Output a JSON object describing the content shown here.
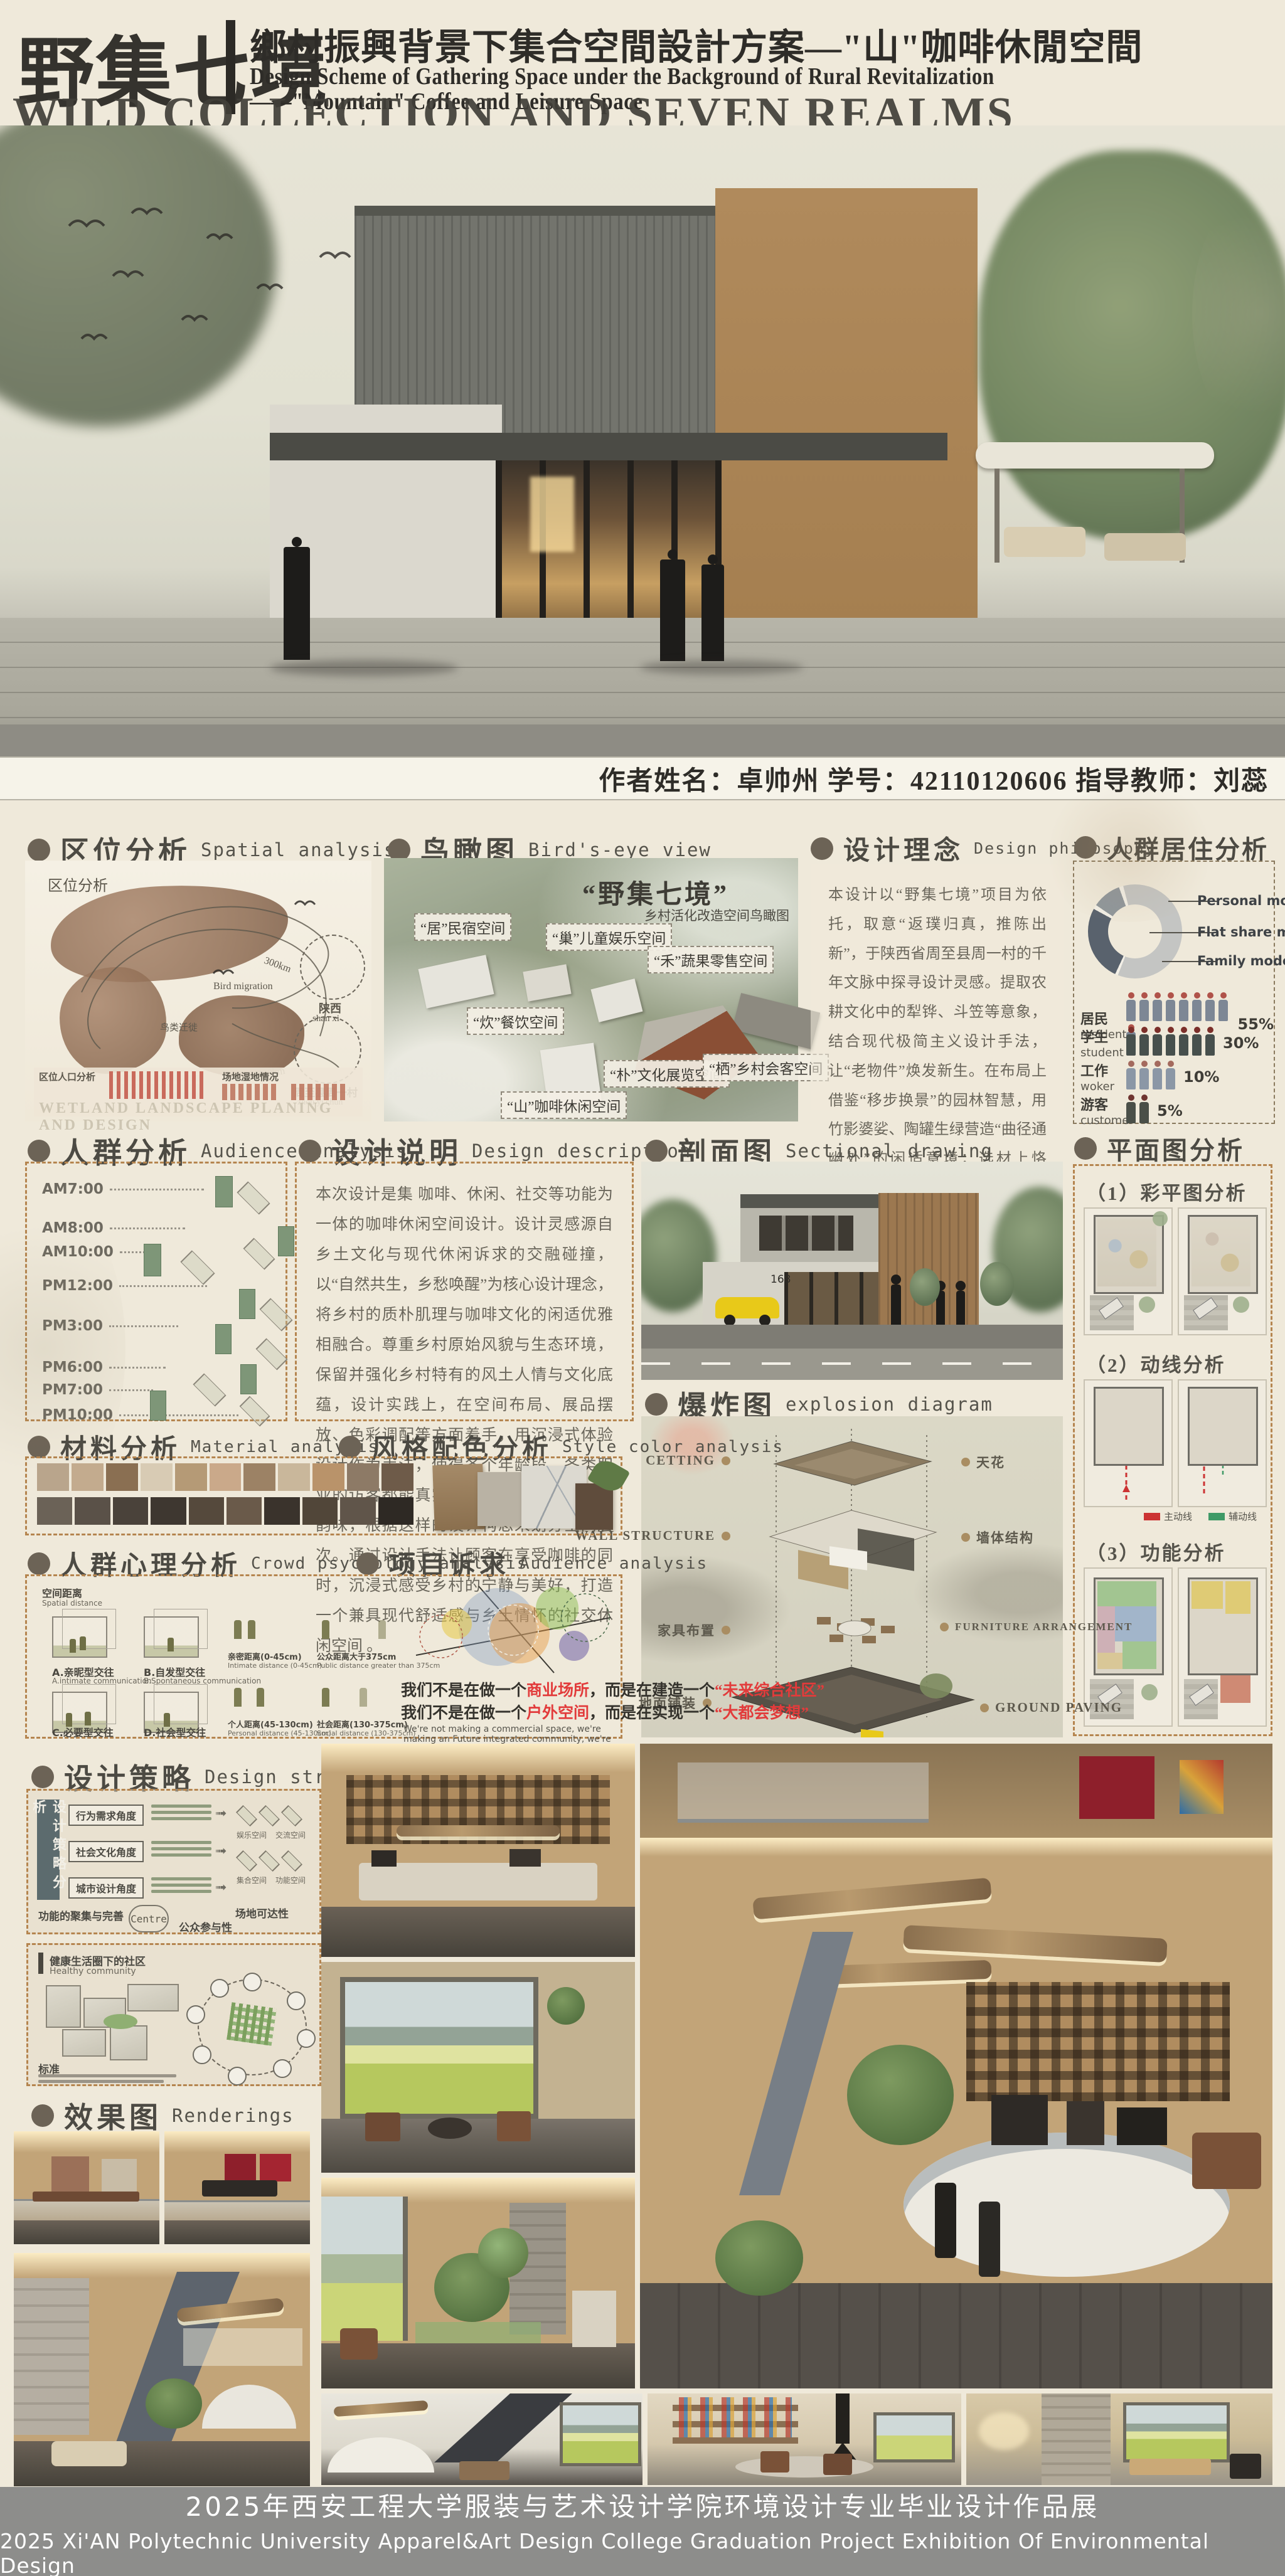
{
  "header": {
    "title_cn": "野集七境",
    "subtitle_cn": "鄉村振興背景下集合空間設計方案—\"山\"咖啡休閒空間",
    "subtitle_en_line1": "Design Scheme of Gathering Space under the Background of Rural Revitalization",
    "subtitle_en_line2": "——\"Mountain\" Coffee and Leisure Space",
    "title_en": "WILD COLLECTION AND SEVEN REALMS"
  },
  "author_bar": {
    "text": "作者姓名：卓帅州  学号：42110120606  指导教师：刘蕊"
  },
  "spatial": {
    "cn": "区位分析",
    "en": "Spatial analysis",
    "corner": "区位分析",
    "bird_migration_en": "Bird migration",
    "bird_migration_cn": "鸟类迁徙",
    "shanxi_cn": "陕西",
    "shanxi_en": "shan xi",
    "dist": "300km",
    "village_cn": "周至县周一村",
    "village_en": "zhou yi chun",
    "pop_label": "区位人口分析",
    "wetland_label": "场地湿地情况",
    "watermark": "WETLAND LANDSCAPE PLANING AND DESIGN"
  },
  "birdseye": {
    "cn": "鸟瞰图",
    "en": "Bird's-eye view",
    "caption_big": "“野集七境”",
    "caption_small": "乡村活化改造空间鸟瞰图",
    "labels": [
      "“居”民宿空间",
      "“巢”儿童娱乐空间",
      "“禾”蔬果零售空间",
      "“炊”餐饮空间",
      "“朴”文化展览空间",
      "“栖”乡村会客空间",
      "“山”咖啡休闲空间"
    ]
  },
  "philosophy": {
    "cn": "设计理念",
    "en": "Design philosophy",
    "body": "本设计以“野集七境”项目为依托，取意“返璞归真，推陈出新”，于陕西省周至县周一村的千年文脉中探寻设计灵感。提取农耕文化中的犁铧、斗笠等意象，结合现代极简主义设计手法，让“老物件”焕发新生。在布局上借鉴“移步换景”的园林智慧，用竹影婆娑、陶罐生绿营造“曲径通幽处”的闲适意境；选材上恪守“因地制宜”，以夯土、原木、藤编传递“道法自然”的生态理念。力求在“古意今承”间，打造一处既能品味咖啡醇香，又可触摸乡土温度的诗意空间，探索乡村公共空间活化的“破界新生”之道。"
  },
  "residence": {
    "cn": "人群居住分析",
    "donut_labels": [
      "Personal mode",
      "Flat share mode",
      "Family mode"
    ],
    "rows": [
      {
        "cn": "居民",
        "en": "resident",
        "pct": "55%",
        "count": 9
      },
      {
        "cn": "学生",
        "en": "student",
        "pct": "30%",
        "count": 7
      },
      {
        "cn": "工作",
        "en": "woker",
        "pct": "10%",
        "count": 4
      },
      {
        "cn": "游客",
        "en": "customer",
        "pct": "5%",
        "count": 2
      }
    ]
  },
  "audience": {
    "cn": "人群分析",
    "en": "Audience analysis",
    "times": [
      "AM7:00",
      "AM8:00",
      "AM10:00",
      "PM12:00",
      "PM3:00",
      "PM6:00",
      "PM7:00",
      "PM10:00"
    ]
  },
  "description": {
    "cn": "设计说明",
    "en": "Design description",
    "body": "本次设计是集 咖啡、休闲、社交等功能为一体的咖啡休闲空间设计。设计灵感源自乡土文化与现代休闲诉求的交融碰撞，以“自然共生，乡愁唤醒”为核心设计理念，将乡村的质朴肌理与咖啡文化的闲适优雅相融合。尊重乡村原始风貌与生态环境，保留并强化乡村特有的风土人情与文化底蕴，设计实践上，在空间布局、展品摆放、色彩调配等方面着手，用沉浸式体验设计作为手法，使得各个年龄段、各类职业的访客都能真实领略到乡土文化的特别韵味，根据这样的设计构思来划分空间层次。通过设计手法让顾客在享受咖啡的同时，沉浸式感受乡村的宁静与美好，打造一个兼具现代舒适感与乡土情怀的社交休闲空间 。"
  },
  "sectional": {
    "cn": "剖面图",
    "en": "Sectional drawing",
    "house_number": "168"
  },
  "plans": {
    "cn": "平面图分析",
    "sub1": "（1）彩平图分析",
    "sub2": "（2）动线分析",
    "sub3": "（3）功能分析",
    "legend_main": "主动线",
    "legend_aux": "辅动线"
  },
  "explosion": {
    "cn": "爆炸图",
    "en": "explosion diagram",
    "l1_left": "CETTING",
    "l1_right": "天花",
    "l2_left": "WALL STRUCTURE",
    "l2_right": "墙体结构",
    "l3_left": "家具布置",
    "l3_right": "FURNITURE ARRANGEMENT",
    "l4_left": "地面铺装",
    "l4_right": "GROUND PAVING"
  },
  "material": {
    "cn": "材料分析",
    "en": "Material analysis"
  },
  "style_color": {
    "cn": "风格配色分析",
    "en": "Style color analysis"
  },
  "psychology": {
    "cn": "人群心理分析",
    "en": "Crowd psychology analysis",
    "space_cn": "空间距离",
    "space_en": "Spatial distance",
    "types": [
      {
        "cn": "A.亲昵型交往",
        "en": "A.intimate communication"
      },
      {
        "cn": "B.自发型交往",
        "en": "B.Spontaneous communication"
      },
      {
        "cn": "C.必要型交往",
        "en": "C.Necessary communication"
      },
      {
        "cn": "D.社会型交往",
        "en": "D.Social communication"
      }
    ],
    "distances": [
      {
        "cn": "亲密距离(0-45cm)",
        "en": "Intimate distance (0-45cm)"
      },
      {
        "cn": "公众距离大于375cm",
        "en": "Public distance greater than 375cm"
      },
      {
        "cn": "个人距离(45-130cm)",
        "en": "Personal distance (45-130cm)"
      },
      {
        "cn": "社会距离(130-375cm)",
        "en": "Social distance (130-375cm)"
      }
    ]
  },
  "appeal": {
    "cn": "项目诉求",
    "en": "Audience analysis",
    "line1_pre": "我们不是在做一个",
    "line1_hl1": "商业场所",
    "line1_mid": "，而是在建造一个",
    "line1_hl2": "“未来综合社区”",
    "line2_pre": "我们不是在做一个",
    "line2_hl1": "户外空间",
    "line2_mid": "，而是在实现一个",
    "line2_hl2": "“大都会梦想”",
    "en_line": "We're not making a commercial space, we're making an Future integrated community, we're not making an outdoor space, we're making The metropolis dream"
  },
  "strategy": {
    "cn": "设计策略",
    "en": "Design strategy",
    "vertical_label": "设计策略分析",
    "angle1": "行为需求角度",
    "angle2": "社会文化角度",
    "angle3": "城市设计角度",
    "iso_labels": [
      "娱乐空间",
      "交流空间",
      "户外运动",
      "私家空间",
      "集合空间",
      "功能空间",
      "休息空间",
      "娱乐空间"
    ],
    "hub_label": "功能的聚集与完善",
    "hub": "Centre",
    "site_label": "场地可达性",
    "public_label": "公众参与性",
    "healthy_cn": "健康生活圈下的社区",
    "healthy_en": "Healthy community",
    "standard": "标准"
  },
  "renderings": {
    "cn": "效果图",
    "en": "Renderings"
  },
  "footer": {
    "line1": "2025年西安工程大学服装与艺术设计学院环境设计专业毕业设计作品展",
    "line2": "2025 Xi'AN Polytechnic University  Apparel&Art  Design  College Graduation Project Exhibition Of Environmental Design"
  },
  "colors": {
    "dashed_border": "#b5854f",
    "footer_bg": "#8d8d8b",
    "red_accent": "#e23b3b",
    "green_accent": "#3f9a67",
    "paper": "#efe9da"
  }
}
